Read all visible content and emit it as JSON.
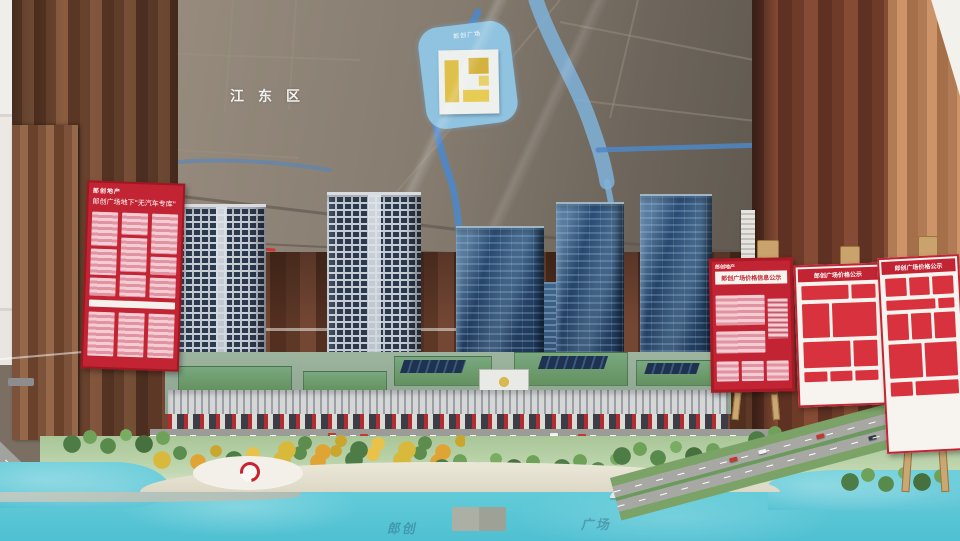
{
  "scene": {
    "type": "photograph",
    "subject": "Architectural scale model of a lakeside mixed-use development in a sales gallery, with wall master-plan map and red price boards"
  },
  "wall_map": {
    "district_label": "江东区",
    "site_label": "郎创广场"
  },
  "signs": {
    "left": {
      "brand": "郎创地产",
      "title": "郎创广场地下\"无汽车专库\""
    },
    "right": [
      {
        "brand": "郎创地产",
        "title": "郎创广场价格信息公示"
      },
      {
        "title": "郎创广场价格公示"
      },
      {
        "title": "郎创广场价格公示"
      }
    ]
  },
  "watermarks": {
    "left": "郎创",
    "right": "广场"
  },
  "colors": {
    "curtain_left": "#6d452f",
    "curtain_right": "#6e3b29",
    "curtain_tan": "#b17c55",
    "map_base": "#857b6f",
    "river_blue": "#4e87c6",
    "site_highlight": "#8fc3e0",
    "site_gold": "#dfc04a",
    "tower_glass": "#1b3150",
    "tower_residential": "#c9ced5",
    "podium_green": "#6f9f76",
    "lake": "#5cc6d6",
    "sign_red": "#c32433",
    "topper_gold": "#ecc65e"
  }
}
